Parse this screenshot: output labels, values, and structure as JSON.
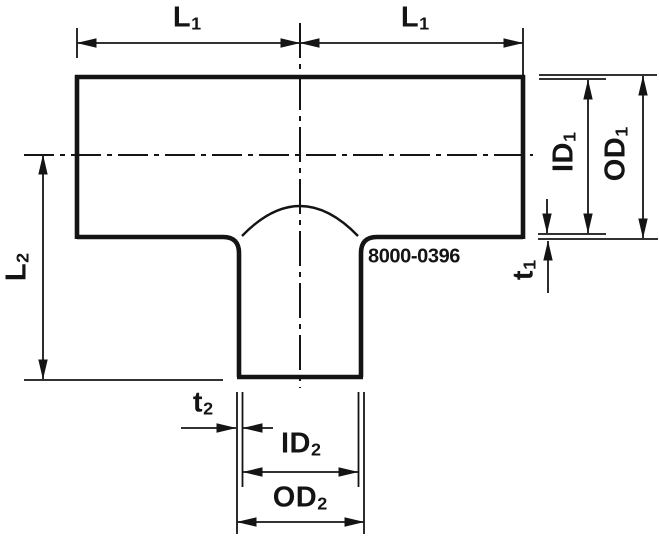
{
  "drawing": {
    "part_number": "8000-0396",
    "line_color": "#141414",
    "background_color": "#ffffff",
    "labels": {
      "l1_left": {
        "base": "L",
        "sub": "1"
      },
      "l1_right": {
        "base": "L",
        "sub": "1"
      },
      "id1": {
        "base": "ID",
        "sub": "1"
      },
      "od1": {
        "base": "OD",
        "sub": "1"
      },
      "t1": {
        "base": "t",
        "sub": "1"
      },
      "l2": {
        "base": "L",
        "sub": "2"
      },
      "t2": {
        "base": "t",
        "sub": "2"
      },
      "id2": {
        "base": "ID",
        "sub": "2"
      },
      "od2": {
        "base": "OD",
        "sub": "2"
      }
    }
  }
}
